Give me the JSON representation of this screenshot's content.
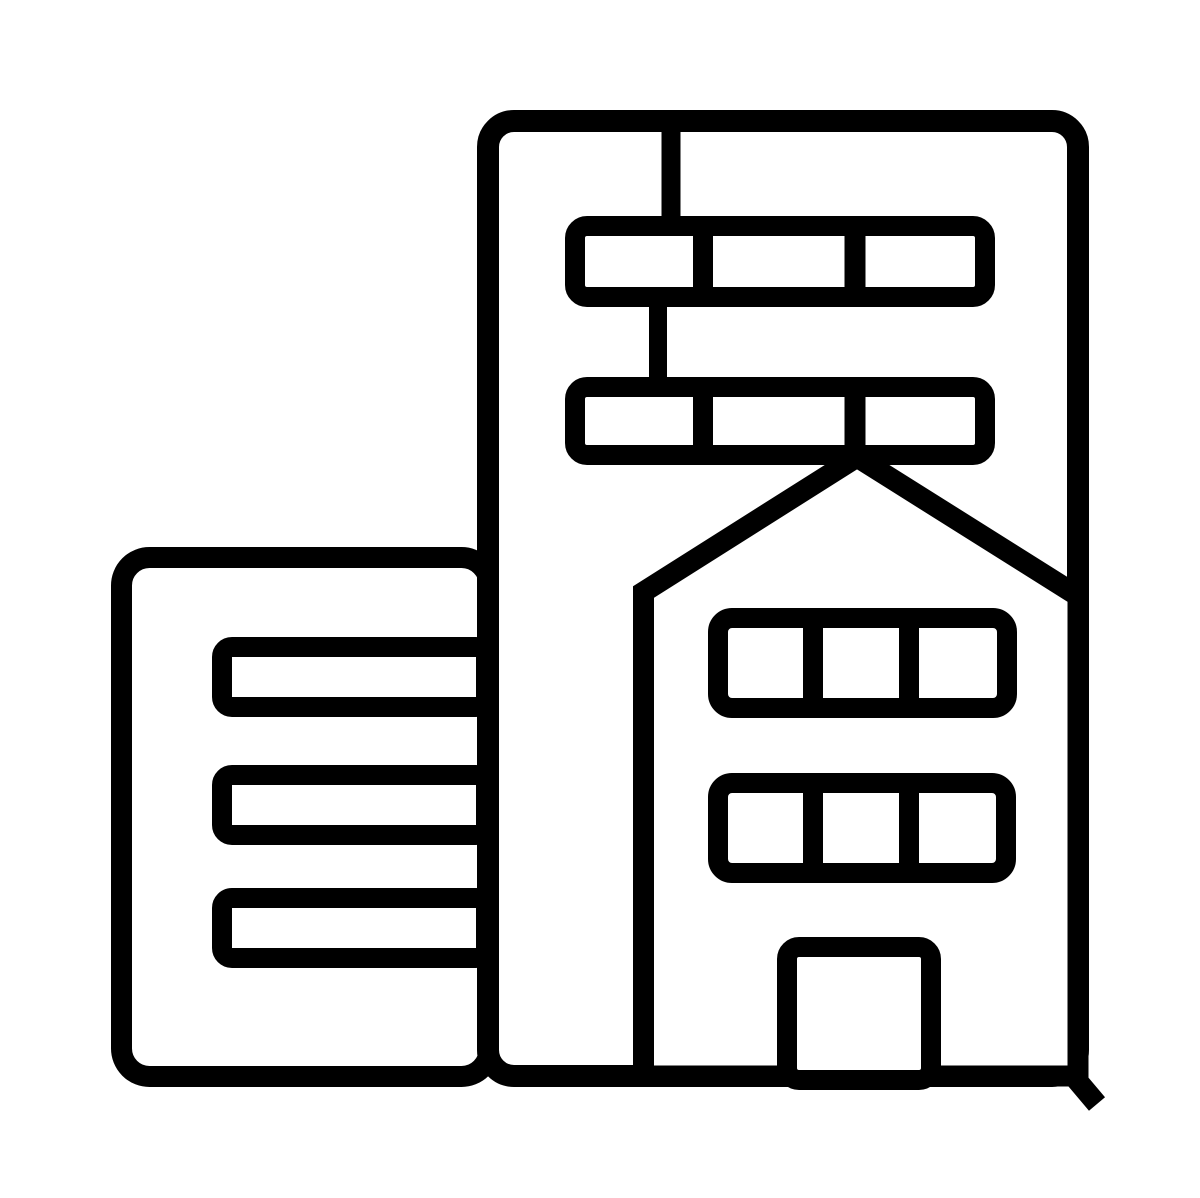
{
  "icon": {
    "name": "city-buildings-icon",
    "description": "Black outline glyph of an office building beside a taller building with a gabled house facade, window strips and a door",
    "background": "#ffffff",
    "stroke_color": "#000000",
    "canvas": {
      "width": 1200,
      "height": 1198
    },
    "shapes": [
      {
        "name": "left-building-body",
        "type": "rect",
        "x": 121.5,
        "y": 557.5,
        "w": 368,
        "h": 519,
        "rx": 28,
        "sw": 21,
        "fill": "#ffffff"
      },
      {
        "name": "left-building-window-bar-1",
        "type": "rect",
        "x": 222,
        "y": 647,
        "w": 264,
        "h": 60,
        "rx": 10,
        "sw": 20,
        "fill": "#ffffff"
      },
      {
        "name": "left-building-window-bar-2",
        "type": "rect",
        "x": 222,
        "y": 775,
        "w": 264,
        "h": 60,
        "rx": 10,
        "sw": 20,
        "fill": "#ffffff"
      },
      {
        "name": "left-building-window-bar-3",
        "type": "rect",
        "x": 222,
        "y": 898,
        "w": 264,
        "h": 60,
        "rx": 10,
        "sw": 20,
        "fill": "#ffffff"
      },
      {
        "name": "right-building-body",
        "type": "rect",
        "x": 488,
        "y": 121,
        "w": 590,
        "h": 955,
        "rx": 26,
        "sw": 22,
        "fill": "#ffffff"
      },
      {
        "name": "window-strip-1-connector",
        "type": "line",
        "x1": 671,
        "y1": 124,
        "x2": 671,
        "y2": 222,
        "sw": 19
      },
      {
        "name": "right-building-window-strip-1",
        "type": "rect",
        "x": 575,
        "y": 226,
        "w": 410,
        "h": 71,
        "rx": 12,
        "sw": 20,
        "fill": "none"
      },
      {
        "name": "strip-1-mullion-1",
        "type": "line",
        "x1": 703,
        "y1": 222,
        "x2": 703,
        "y2": 301,
        "sw": 20
      },
      {
        "name": "strip-1-mullion-2",
        "type": "line",
        "x1": 855,
        "y1": 222,
        "x2": 855,
        "y2": 301,
        "sw": 21
      },
      {
        "name": "window-strip-2-connector",
        "type": "line",
        "x1": 658,
        "y1": 303,
        "x2": 658,
        "y2": 383,
        "sw": 18
      },
      {
        "name": "right-building-window-strip-2",
        "type": "rect",
        "x": 575,
        "y": 387,
        "w": 410,
        "h": 68,
        "rx": 12,
        "sw": 20,
        "fill": "none"
      },
      {
        "name": "strip-2-mullion-1",
        "type": "line",
        "x1": 703,
        "y1": 383,
        "x2": 703,
        "y2": 459,
        "sw": 20
      },
      {
        "name": "strip-2-mullion-2",
        "type": "line",
        "x1": 855,
        "y1": 383,
        "x2": 855,
        "y2": 459,
        "sw": 21
      },
      {
        "name": "house-body",
        "type": "path",
        "d": "M 643.5 1076 L 643.5 592 L 857 457 L 1078 596 L 1078 1076 Z",
        "sw": 21,
        "fill": "#ffffff"
      },
      {
        "name": "house-window-strip-1",
        "type": "rect",
        "x": 718,
        "y": 618,
        "w": 289,
        "h": 90,
        "rx": 14,
        "sw": 20,
        "fill": "none"
      },
      {
        "name": "house-strip-1-mullion-1",
        "type": "line",
        "x1": 813,
        "y1": 614,
        "x2": 813,
        "y2": 712,
        "sw": 20
      },
      {
        "name": "house-strip-1-mullion-2",
        "type": "line",
        "x1": 909,
        "y1": 614,
        "x2": 909,
        "y2": 712,
        "sw": 20
      },
      {
        "name": "house-window-strip-2",
        "type": "rect",
        "x": 718,
        "y": 783,
        "w": 288,
        "h": 90,
        "rx": 14,
        "sw": 20,
        "fill": "none"
      },
      {
        "name": "house-strip-2-mullion-1",
        "type": "line",
        "x1": 813,
        "y1": 779,
        "x2": 813,
        "y2": 877,
        "sw": 20
      },
      {
        "name": "house-strip-2-mullion-2",
        "type": "line",
        "x1": 909,
        "y1": 779,
        "x2": 909,
        "y2": 877,
        "sw": 20
      },
      {
        "name": "house-door",
        "type": "rect",
        "x": 787,
        "y": 947,
        "w": 144,
        "h": 133,
        "rx": 12,
        "sw": 20,
        "fill": "#ffffff"
      },
      {
        "name": "baseline-tail",
        "type": "line",
        "x1": 1070,
        "y1": 1072,
        "x2": 1097,
        "y2": 1104,
        "sw": 21
      }
    ]
  }
}
